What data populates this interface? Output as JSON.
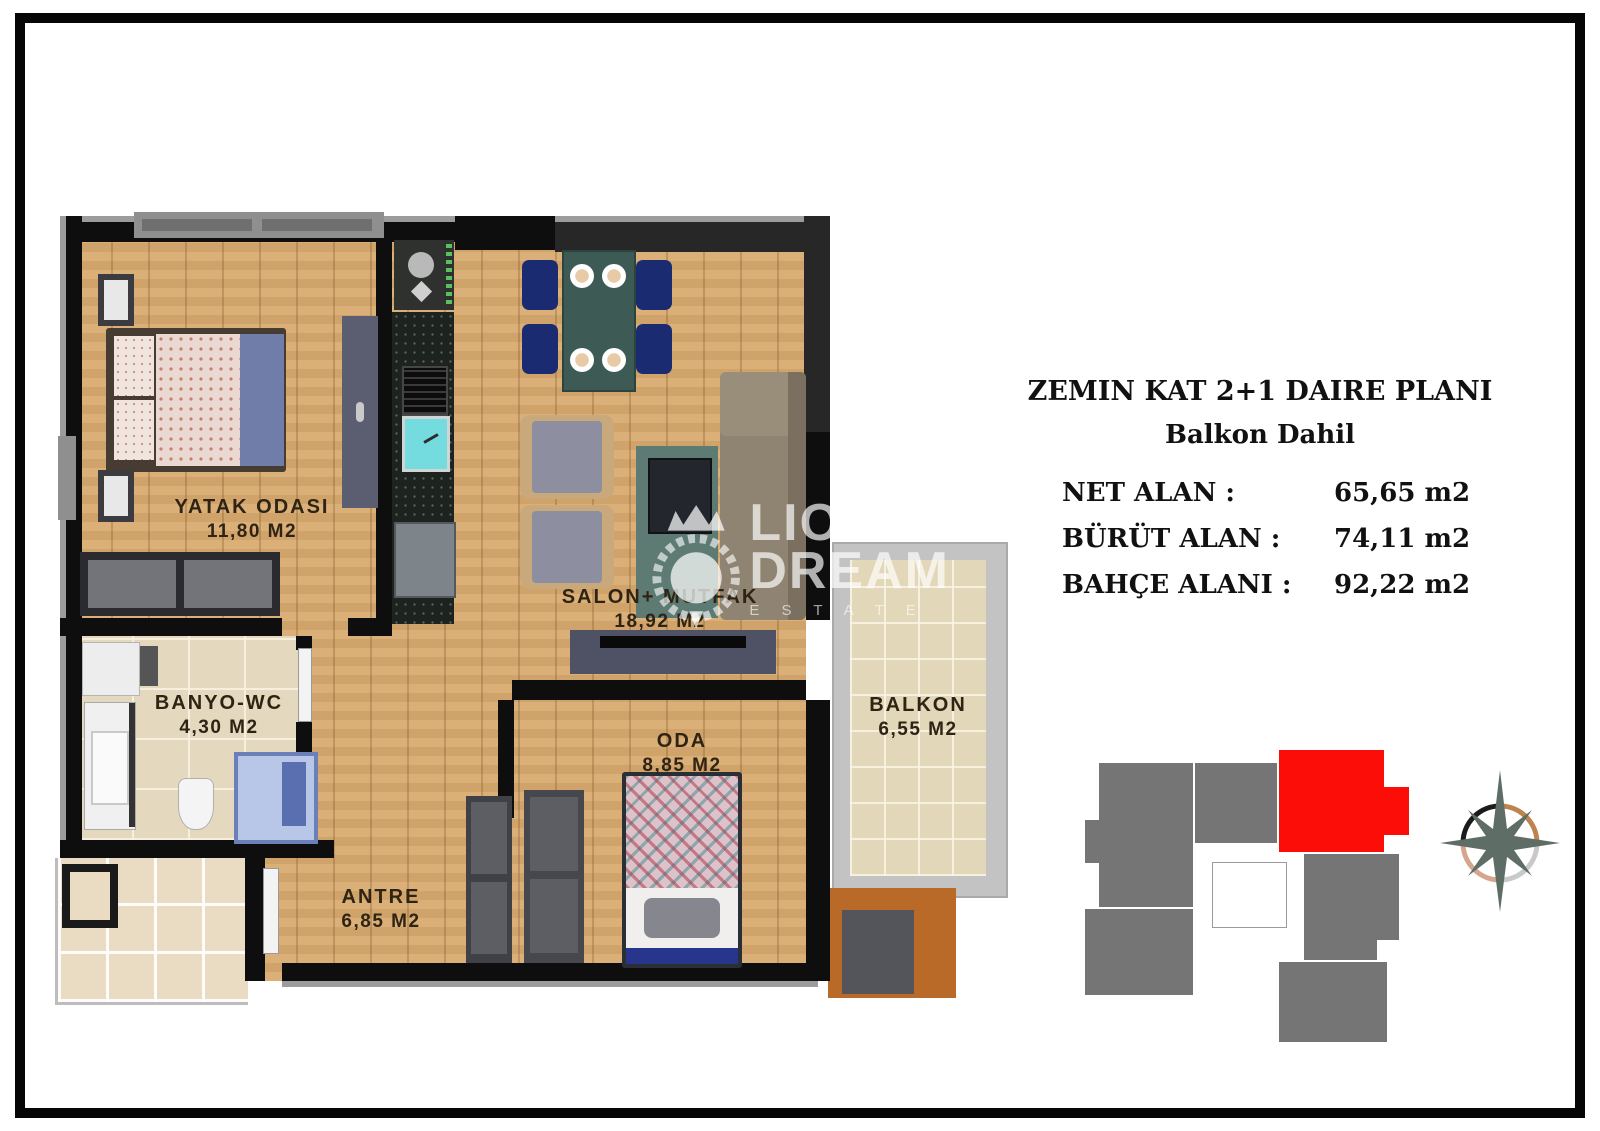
{
  "info": {
    "title": "ZEMIN KAT  2+1 DAIRE PLANI",
    "subtitle": "Balkon Dahil",
    "specs": [
      {
        "label": "NET ALAN :",
        "value": "65,65 m2"
      },
      {
        "label": "BÜRÜT ALAN :",
        "value": "74,11 m2"
      },
      {
        "label": "BAHÇE ALANI :",
        "value": "92,22 m2"
      }
    ]
  },
  "plan": {
    "rooms": [
      {
        "name": "YATAK ODASI",
        "area": "11,80 M2"
      },
      {
        "name": "SALON+ MUTFAK",
        "area": "18,92 M2"
      },
      {
        "name": "BANYO-WC",
        "area": "4,30 M2"
      },
      {
        "name": "ANTRE",
        "area": "6,85 M2"
      },
      {
        "name": "ODA",
        "area": "8,85 M2"
      },
      {
        "name": "BALKON",
        "area": "6,55 M2"
      }
    ]
  },
  "watermark": {
    "line1": "LION",
    "line2": "DREAM",
    "line3": "E S T A T E"
  },
  "key_plan": {
    "highlight_color": "#fd0d08",
    "block_color": "#757575"
  },
  "colors": {
    "wall": "#0e0e0e",
    "wood_floor": "#d7aa70",
    "tile_floor": "#e4d9bf",
    "counter": "#1d241f"
  },
  "icons": [
    "lion-crown-logo-icon",
    "compass-rose-icon"
  ]
}
